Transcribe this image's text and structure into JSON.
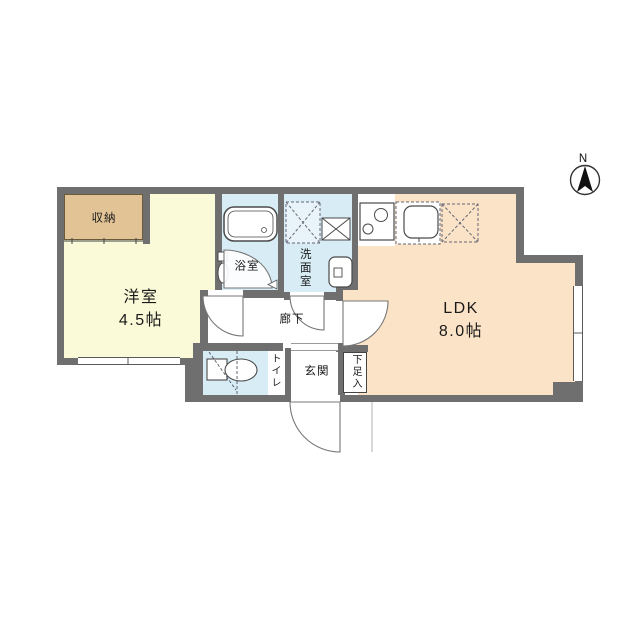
{
  "compass": {
    "label": "N"
  },
  "rooms": {
    "storage": {
      "label": "収納"
    },
    "western": {
      "label": "洋室",
      "size": "4.5帖"
    },
    "bath": {
      "label": "浴室"
    },
    "wash": {
      "label": "洗面室"
    },
    "ldk": {
      "label": "LDK",
      "size": "8.0帖"
    },
    "hall": {
      "label": "廊下"
    },
    "toilet": {
      "label": "トイレ"
    },
    "entrance": {
      "label": "玄関"
    },
    "shoe": {
      "label": "下足入"
    }
  },
  "colors": {
    "wall": "#6f6f6f",
    "western_floor": "#fafad9",
    "storage_floor": "#e1c395",
    "wet_floor": "#d7ecf5",
    "ldk_floor": "#fae3c6",
    "line": "#555555"
  }
}
